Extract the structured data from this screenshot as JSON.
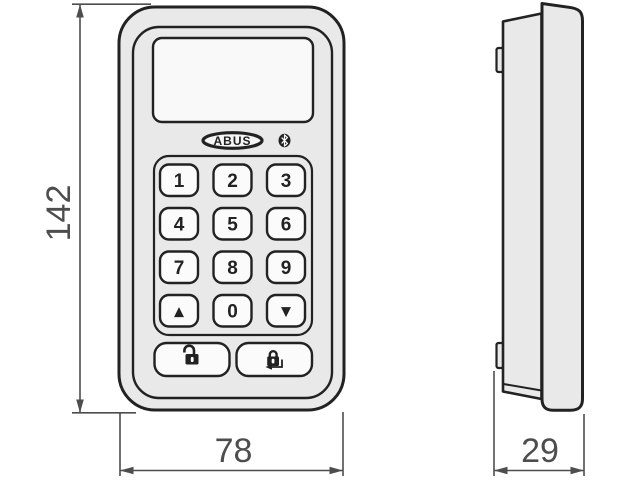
{
  "dimensions": {
    "height": "142",
    "width": "78",
    "depth": "29"
  },
  "front_view": {
    "brand_logo": "ABUS",
    "bluetooth_icon": "bluetooth",
    "keys": [
      {
        "name": "key-1",
        "label": "1"
      },
      {
        "name": "key-2",
        "label": "2"
      },
      {
        "name": "key-3",
        "label": "3"
      },
      {
        "name": "key-4",
        "label": "4"
      },
      {
        "name": "key-5",
        "label": "5"
      },
      {
        "name": "key-6",
        "label": "6"
      },
      {
        "name": "key-7",
        "label": "7"
      },
      {
        "name": "key-8",
        "label": "8"
      },
      {
        "name": "key-9",
        "label": "9"
      },
      {
        "name": "key-up",
        "label": "▲"
      },
      {
        "name": "key-0",
        "label": "0"
      },
      {
        "name": "key-down",
        "label": "▼"
      }
    ],
    "function_buttons": [
      {
        "name": "unlock-button",
        "icon": "open-padlock"
      },
      {
        "name": "lock-enter-button",
        "icon": "closed-padlock-with-enter-arrow"
      }
    ]
  },
  "colors": {
    "body_fill": "#e9e9e9",
    "key_fill": "#fbfbfb",
    "outline": "#222222",
    "dimension": "#4d4d4d"
  }
}
